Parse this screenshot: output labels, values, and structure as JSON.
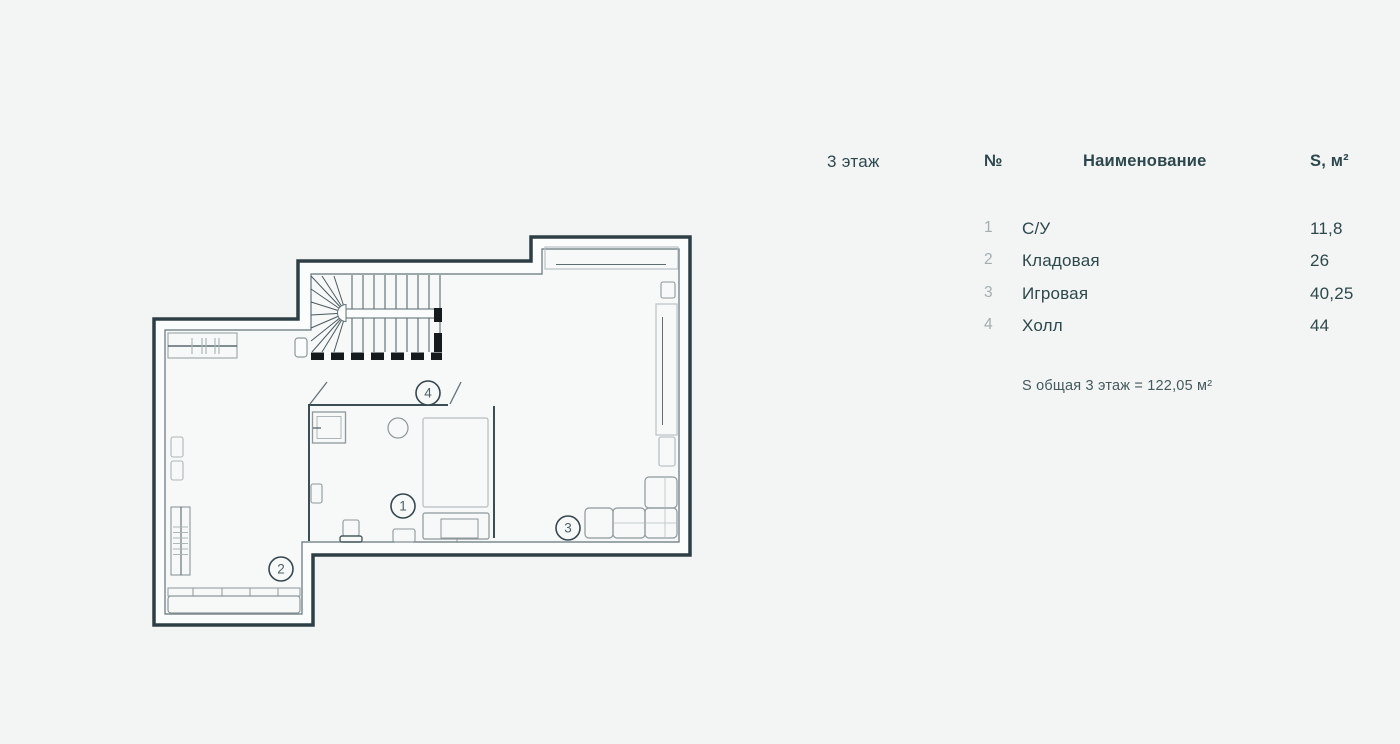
{
  "legend": {
    "floor_label": "3 этаж",
    "columns": {
      "num": "№",
      "name": "Наименование",
      "area": "S, м²"
    },
    "rows": [
      {
        "num": "1",
        "name": "С/У",
        "area": "11,8"
      },
      {
        "num": "2",
        "name": "Кладовая",
        "area": "26"
      },
      {
        "num": "3",
        "name": "Игровая",
        "area": "40,25"
      },
      {
        "num": "4",
        "name": "Холл",
        "area": "44"
      }
    ],
    "total": "S общая 3 этаж = 122,05 м²"
  },
  "plan": {
    "room_labels": [
      {
        "n": "1"
      },
      {
        "n": "2"
      },
      {
        "n": "3"
      },
      {
        "n": "4"
      }
    ],
    "colors": {
      "wall_dark": "#2e3e45",
      "wall_inner_line": "#64747a",
      "wall_core": "#fbfcfc",
      "floor": "#f7f8f8",
      "furniture_gray": "#8d989b",
      "furniture_light": "#b5bec0",
      "stair_line": "#4a5a60",
      "cut_black": "#151a1c",
      "label_ring": "#37474f",
      "label_text": "#4f6165",
      "page_bg": "#f3f4f4",
      "text_dark": "#2d484c",
      "text_muted": "#a3aeb0"
    }
  }
}
